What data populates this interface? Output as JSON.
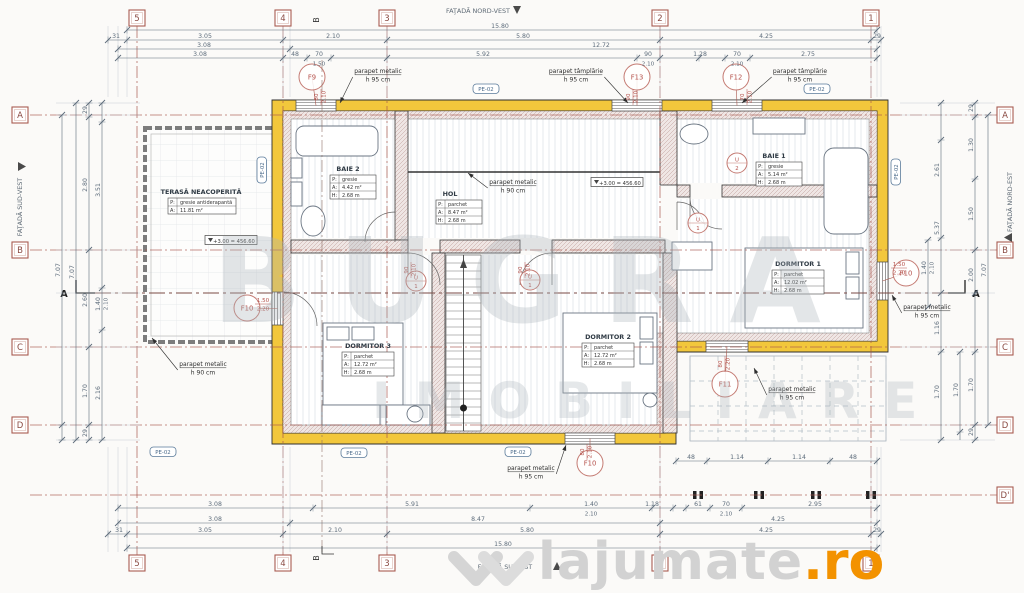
{
  "canvas": {
    "w": 1024,
    "h": 593
  },
  "colors": {
    "bg": "#fbfaf8",
    "wall": "#f2c73c",
    "wall_edge": "#2f2f2f",
    "dim": "#5d6c7b",
    "axis": "#a8564c",
    "red": "#b5524c",
    "dark": "#3a3a3a",
    "gray": "#6b7683",
    "badge": "#4a6a8a",
    "ext": "#b9c2ca"
  },
  "watermark": {
    "line1": "BUGRA",
    "line2": "IMOBILIARE"
  },
  "site_logo": {
    "name": "lajumate",
    "tld": ".ro"
  },
  "facades": {
    "top": "FAŢADĂ NORD-VEST",
    "bottom": "FAŢADĂ SUD-EST",
    "left": "FAŢADĂ SUD-VEST",
    "right": "FAŢADĂ NORD-EST"
  },
  "grid": {
    "cols": [
      {
        "label": "5",
        "x": 137
      },
      {
        "label": "4",
        "x": 283
      },
      {
        "label": "3",
        "x": 387
      },
      {
        "label": "2",
        "x": 660
      },
      {
        "label": "1",
        "x": 871
      }
    ],
    "col_b": {
      "label": "B",
      "x": 322
    },
    "rows_left": [
      {
        "label": "A",
        "y": 115
      },
      {
        "label": "B",
        "y": 250
      },
      {
        "label": "C",
        "y": 347
      },
      {
        "label": "D",
        "y": 425
      }
    ],
    "rows_right": [
      {
        "label": "A",
        "y": 115
      },
      {
        "label": "B",
        "y": 250
      },
      {
        "label": "C",
        "y": 347
      },
      {
        "label": "D",
        "y": 425
      },
      {
        "label": "D'",
        "y": 495
      }
    ],
    "top_y": 18,
    "bottom_y": 563,
    "left_x": 20,
    "right_x": 1005
  },
  "section": {
    "label": "A",
    "y": 293
  },
  "rooms": [
    {
      "name": "TERASĂ NEACOPERITĂ",
      "rows": [
        [
          "P:",
          "gresie antiderapantă"
        ],
        [
          "A:",
          "11.81 m²"
        ]
      ],
      "tx": 201,
      "ty": 194,
      "bx": 168,
      "by": 198,
      "bw": 68,
      "rh": 8
    },
    {
      "name": "BAIE 2",
      "rows": [
        [
          "P:",
          "gresie"
        ],
        [
          "A:",
          "4.42 m²"
        ],
        [
          "H:",
          "2.68 m"
        ]
      ],
      "tx": 348,
      "ty": 171,
      "bx": 330,
      "by": 175,
      "bw": 46,
      "rh": 8
    },
    {
      "name": "HOL",
      "rows": [
        [
          "P:",
          "parchet"
        ],
        [
          "A:",
          "8.47 m²"
        ],
        [
          "H:",
          "2.68 m"
        ]
      ],
      "tx": 450,
      "ty": 196,
      "bx": 436,
      "by": 200,
      "bw": 46,
      "rh": 8
    },
    {
      "name": "BAIE 1",
      "rows": [
        [
          "P:",
          "gresie"
        ],
        [
          "A:",
          "5.14 m²"
        ],
        [
          "H:",
          "2.68 m"
        ]
      ],
      "tx": 774,
      "ty": 158,
      "bx": 756,
      "by": 162,
      "bw": 46,
      "rh": 8
    },
    {
      "name": "DORMITOR 1",
      "rows": [
        [
          "P:",
          "parchet"
        ],
        [
          "A:",
          "12.02 m²"
        ],
        [
          "H:",
          "2.68 m"
        ]
      ],
      "tx": 798,
      "ty": 266,
      "bx": 772,
      "by": 270,
      "bw": 52,
      "rh": 8
    },
    {
      "name": "DORMITOR 2",
      "rows": [
        [
          "P:",
          "parchet"
        ],
        [
          "A:",
          "12.72 m²"
        ],
        [
          "H:",
          "2.68 m"
        ]
      ],
      "tx": 608,
      "ty": 339,
      "bx": 582,
      "by": 343,
      "bw": 52,
      "rh": 8
    },
    {
      "name": "DORMITOR 3",
      "rows": [
        [
          "P:",
          "parchet"
        ],
        [
          "A:",
          "12.72 m²"
        ],
        [
          "H:",
          "2.68 m"
        ]
      ],
      "tx": 368,
      "ty": 348,
      "bx": 342,
      "by": 352,
      "bw": 52,
      "rh": 8
    }
  ],
  "levels": [
    {
      "text": "+3.00 = 456.60",
      "x": 231,
      "y": 241
    },
    {
      "text": "+3.00 = 456.60",
      "x": 617,
      "y": 183
    }
  ],
  "badges": [
    {
      "text": "PE-02",
      "x": 486,
      "y": 89,
      "rot": 0
    },
    {
      "text": "PE-02",
      "x": 817,
      "y": 89,
      "rot": 0
    },
    {
      "text": "PE-02",
      "x": 354,
      "y": 453,
      "rot": 0
    },
    {
      "text": "PE-02",
      "x": 163,
      "y": 452,
      "rot": 0
    },
    {
      "text": "PE-02",
      "x": 518,
      "y": 452,
      "rot": 0
    },
    {
      "text": "PE-02",
      "x": 262,
      "y": 170,
      "rot": -90
    },
    {
      "text": "PE-02",
      "x": 896,
      "y": 172,
      "rot": -90
    }
  ],
  "parapets": [
    {
      "l1": "parapet metalic",
      "l2": "h 95 cm",
      "x": 378,
      "y": 73,
      "ax": 340,
      "ay": 103
    },
    {
      "l1": "parapet tâmplărie",
      "l2": "h 95 cm",
      "x": 576,
      "y": 73,
      "ax": 628,
      "ay": 103
    },
    {
      "l1": "parapet tâmplărie",
      "l2": "h 95 cm",
      "x": 800,
      "y": 73,
      "ax": 742,
      "ay": 103
    },
    {
      "l1": "parapet metalic",
      "l2": "h 90 cm",
      "x": 203,
      "y": 366,
      "ax": 152,
      "ay": 338
    },
    {
      "l1": "parapet metalic",
      "l2": "h 90 cm",
      "x": 513,
      "y": 184,
      "ax": 468,
      "ay": 173
    },
    {
      "l1": "parapet metalic",
      "l2": "h 95 cm",
      "x": 531,
      "y": 470,
      "ax": 566,
      "ay": 445
    },
    {
      "l1": "parapet metalic",
      "l2": "h 95 cm",
      "x": 927,
      "y": 309,
      "ax": 892,
      "ay": 295
    },
    {
      "l1": "parapet metalic",
      "l2": "h 95 cm",
      "x": 792,
      "y": 391,
      "ax": 754,
      "ay": 368
    }
  ],
  "windows": [
    {
      "id": "F9",
      "cx": 312,
      "cy": 77,
      "gx": 296,
      "gy": 100,
      "gw": 40,
      "gh": 11,
      "dir": "h"
    },
    {
      "id": "F13",
      "cx": 637,
      "cy": 77,
      "gx": 612,
      "gy": 100,
      "gw": 50,
      "gh": 11,
      "dir": "h"
    },
    {
      "id": "F12",
      "cx": 736,
      "cy": 77,
      "gx": 712,
      "gy": 100,
      "gw": 50,
      "gh": 11,
      "dir": "h"
    },
    {
      "id": "F10",
      "cx": 906,
      "cy": 273,
      "gx": 877,
      "gy": 262,
      "gw": 11,
      "gh": 38,
      "dir": "v"
    },
    {
      "id": "F10",
      "cx": 590,
      "cy": 463,
      "gx": 565,
      "gy": 433,
      "gw": 50,
      "gh": 11,
      "dir": "h"
    },
    {
      "id": "F11",
      "cx": 725,
      "cy": 384,
      "gx": 706,
      "gy": 341,
      "gw": 42,
      "gh": 11,
      "dir": "h"
    },
    {
      "id": "F10",
      "cx": 247,
      "cy": 308,
      "gx": 272,
      "gy": 292,
      "gw": 11,
      "gh": 33,
      "dir": "v"
    }
  ],
  "doors": [
    {
      "id": "U/1",
      "cx": 416,
      "cy": 281
    },
    {
      "id": "U/1",
      "cx": 530,
      "cy": 280
    },
    {
      "id": "U/2",
      "cx": 737,
      "cy": 163
    },
    {
      "id": "U/1",
      "cx": 698,
      "cy": 223
    }
  ],
  "red_dims": [
    {
      "t": "80",
      "s": "2.10",
      "x": 318,
      "y": 97,
      "rot": -90
    },
    {
      "t": "90",
      "s": "2.10",
      "x": 630,
      "y": 97,
      "rot": -90
    },
    {
      "t": "70",
      "s": "2.10",
      "x": 744,
      "y": 97,
      "rot": -90
    },
    {
      "t": "1.50",
      "s": "2.20",
      "x": 899,
      "y": 266,
      "rot": 0
    },
    {
      "t": "80",
      "s": "2.10",
      "x": 584,
      "y": 452,
      "rot": -90
    },
    {
      "t": "80",
      "s": "2.20",
      "x": 722,
      "y": 364,
      "rot": -90
    },
    {
      "t": "1.50",
      "s": "2.20",
      "x": 263,
      "y": 302,
      "rot": 0
    },
    {
      "t": "90",
      "s": "2.10",
      "x": 408,
      "y": 270,
      "rot": -90
    },
    {
      "t": "90",
      "s": "2.10",
      "x": 522,
      "y": 270,
      "rot": -90
    }
  ],
  "dims": {
    "top": [
      {
        "y": 30,
        "x1": 127,
        "x2": 877,
        "ticks": [
          127,
          877
        ],
        "labels": [
          {
            "x": 500,
            "t": "15.80"
          }
        ]
      },
      {
        "y": 40,
        "x1": 108,
        "x2": 881,
        "ticks": [
          108,
          127,
          283,
          387,
          660,
          871,
          881
        ],
        "labels": [
          {
            "x": 116,
            "t": "31"
          },
          {
            "x": 205,
            "t": "3.05"
          },
          {
            "x": 333,
            "t": "2.10"
          },
          {
            "x": 523,
            "t": "5.80"
          },
          {
            "x": 766,
            "t": "4.25"
          },
          {
            "x": 877,
            "t": "29"
          }
        ]
      },
      {
        "y": 49,
        "x1": 118,
        "x2": 877,
        "ticks": [
          118,
          290,
          877
        ],
        "labels": [
          {
            "x": 204,
            "t": "3.08"
          },
          {
            "x": 601,
            "t": "12.72"
          }
        ]
      },
      {
        "y": 58,
        "x1": 118,
        "x2": 877,
        "ticks": [
          118,
          283,
          307,
          331,
          387,
          637,
          660,
          699,
          725,
          750,
          877
        ],
        "labels": [
          {
            "x": 200,
            "t": "3.08"
          },
          {
            "x": 295,
            "t": "48"
          },
          {
            "x": 319,
            "t": "70",
            "s": "1.50"
          },
          {
            "x": 483,
            "t": "5.92"
          },
          {
            "x": 648,
            "t": "90",
            "s": "2.10"
          },
          {
            "x": 700,
            "t": "1.28"
          },
          {
            "x": 737,
            "t": "70",
            "s": "2.10"
          },
          {
            "x": 808,
            "t": "2.75"
          }
        ]
      }
    ],
    "bottom": [
      {
        "y": 461,
        "x1": 676,
        "x2": 877,
        "ticks": [
          676,
          707,
          768,
          830,
          877
        ],
        "labels": [
          {
            "x": 691,
            "t": "48"
          },
          {
            "x": 737,
            "t": "1.14"
          },
          {
            "x": 799,
            "t": "1.14"
          },
          {
            "x": 853,
            "t": "48"
          }
        ]
      },
      {
        "y": 508,
        "x1": 118,
        "x2": 877,
        "ticks": [
          118,
          313,
          530,
          652,
          673,
          686,
          710,
          742,
          877
        ],
        "labels": [
          {
            "x": 215,
            "t": "3.08"
          },
          {
            "x": 412,
            "t": "5.91"
          },
          {
            "x": 591,
            "t": "1.40",
            "s": "2.10"
          },
          {
            "x": 652,
            "t": "1.18"
          },
          {
            "x": 698,
            "t": "61"
          },
          {
            "x": 726,
            "t": "70",
            "s": "2.10"
          },
          {
            "x": 815,
            "t": "2.95"
          }
        ]
      },
      {
        "y": 523,
        "x1": 118,
        "x2": 877,
        "ticks": [
          118,
          290,
          660,
          877
        ],
        "labels": [
          {
            "x": 215,
            "t": "3.08"
          },
          {
            "x": 478,
            "t": "8.47"
          },
          {
            "x": 778,
            "t": "4.25"
          }
        ]
      },
      {
        "y": 534,
        "x1": 108,
        "x2": 881,
        "ticks": [
          108,
          127,
          283,
          387,
          660,
          871,
          881
        ],
        "labels": [
          {
            "x": 119,
            "t": "31"
          },
          {
            "x": 205,
            "t": "3.05"
          },
          {
            "x": 335,
            "t": "2.10"
          },
          {
            "x": 527,
            "t": "5.80"
          },
          {
            "x": 766,
            "t": "4.25"
          },
          {
            "x": 877,
            "t": "29"
          }
        ]
      },
      {
        "y": 548,
        "x1": 127,
        "x2": 877,
        "ticks": [
          127,
          877
        ],
        "labels": [
          {
            "x": 503,
            "t": "15.80"
          }
        ]
      }
    ],
    "left": [
      {
        "x": 62,
        "y1": 115,
        "y2": 440,
        "ticks": [
          115,
          425,
          440
        ],
        "labels": [
          {
            "y": 270,
            "t": "7.07"
          }
        ]
      },
      {
        "x": 76,
        "y1": 103,
        "y2": 440,
        "ticks": [
          103,
          440
        ],
        "labels": [
          {
            "y": 272,
            "t": "7.07"
          }
        ]
      },
      {
        "x": 89,
        "y1": 103,
        "y2": 440,
        "ticks": [
          103,
          117,
          250,
          347,
          425,
          440
        ],
        "labels": [
          {
            "y": 110,
            "t": "29"
          },
          {
            "y": 185,
            "t": "2.80"
          },
          {
            "y": 300,
            "t": "2.60"
          },
          {
            "y": 391,
            "t": "1.70"
          },
          {
            "y": 433,
            "t": "29"
          }
        ]
      },
      {
        "x": 102,
        "y1": 103,
        "y2": 440,
        "ticks": [
          103,
          122,
          288,
          330,
          440
        ],
        "labels": [
          {
            "y": 190,
            "t": "3.51"
          },
          {
            "y": 304,
            "t": "1.40",
            "s": "2.10"
          },
          {
            "y": 393,
            "t": "2.16"
          }
        ]
      }
    ],
    "right": [
      {
        "x": 928,
        "y1": 240,
        "y2": 307,
        "ticks": [
          240,
          307
        ],
        "labels": [
          {
            "y": 268,
            "t": "1.40",
            "s": "2.10"
          }
        ]
      },
      {
        "x": 941,
        "y1": 103,
        "y2": 440,
        "ticks": [
          103,
          140,
          238,
          293,
          352,
          440
        ],
        "labels": [
          {
            "y": 170,
            "t": "2.61"
          },
          {
            "y": 228,
            "t": "5.37"
          },
          {
            "y": 328,
            "t": "1.16"
          },
          {
            "y": 392,
            "t": "1.70"
          }
        ]
      },
      {
        "x": 960,
        "y1": 352,
        "y2": 440,
        "ticks": [
          352,
          432
        ],
        "labels": [
          {
            "y": 390,
            "t": "1.70"
          }
        ]
      },
      {
        "x": 975,
        "y1": 103,
        "y2": 440,
        "ticks": [
          103,
          117,
          179,
          250,
          293,
          352,
          425,
          440
        ],
        "labels": [
          {
            "y": 108,
            "t": "29"
          },
          {
            "y": 145,
            "t": "1.30"
          },
          {
            "y": 214,
            "t": "1.50"
          },
          {
            "y": 275,
            "t": "2.00"
          },
          {
            "y": 385,
            "t": "1.70"
          },
          {
            "y": 432,
            "t": "29"
          }
        ]
      },
      {
        "x": 988,
        "y1": 115,
        "y2": 425,
        "ticks": [
          115,
          425
        ],
        "labels": [
          {
            "y": 270,
            "t": "7.07"
          }
        ]
      }
    ]
  }
}
